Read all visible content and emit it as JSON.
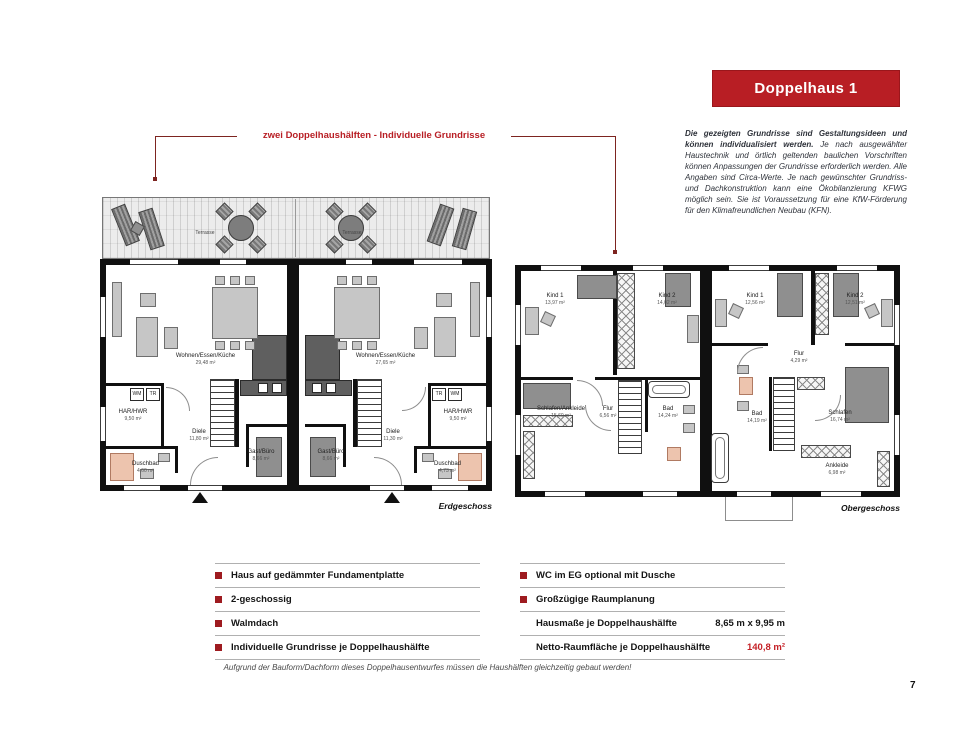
{
  "colors": {
    "accent": "#b81e24",
    "bullet": "#9e1b20",
    "value_red": "#c42026",
    "callout_line": "#7d2420"
  },
  "banner": {
    "title": "Doppelhaus 1"
  },
  "intro": {
    "bold": "Die gezeigten Grundrisse sind Gestaltungsideen und können individualisiert werden.",
    "rest": " Je nach ausgewählter Haustechnik und örtlich geltenden baulichen Vorschriften können Anpassungen der Grundrisse erforderlich werden. Alle Angaben sind Circa-Werte. Je nach gewünschter Grundriss- und Dachkonstruktion kann eine Ökobilanzierung KFWG möglich sein. Sie ist Voraussetzung für eine KfW-Förderung für den Klimafreundlichen Neubau (KFN)."
  },
  "callout": {
    "label": "zwei Doppelhaushälften - Individuelle Grundrisse"
  },
  "plans": {
    "eg": {
      "caption": "Erdgeschoss",
      "terrace_left": "Terrasse",
      "terrace_right": "Terrasse",
      "left": {
        "wohnen": {
          "name": "Wohnen/Essen/Küche",
          "area": "29,48 m²"
        },
        "har": {
          "name": "HAR/HWR",
          "area": "9,50 m²"
        },
        "diele": {
          "name": "Diele",
          "area": "11,80 m²"
        },
        "gast": {
          "name": "Gast/Büro",
          "area": "8,66 m²"
        },
        "bad": {
          "name": "Duschbad",
          "area": "4,60 m²"
        },
        "wm": "WM",
        "tr": "TR"
      },
      "right": {
        "wohnen": {
          "name": "Wohnen/Essen/Küche",
          "area": "27,65 m²"
        },
        "har": {
          "name": "HAR/HWR",
          "area": "9,50 m²"
        },
        "diele": {
          "name": "Diele",
          "area": "11,30 m²"
        },
        "gast": {
          "name": "Gast/Büro",
          "area": "8,66 m²"
        },
        "bad": {
          "name": "Duschbad",
          "area": "4,73 m²"
        },
        "tr": "TR",
        "wm": "WM"
      }
    },
    "og": {
      "caption": "Obergeschoss",
      "left": {
        "kind1": {
          "name": "Kind 1",
          "area": "13,97 m²"
        },
        "kind2": {
          "name": "Kind 2",
          "area": "14,02 m²"
        },
        "schlafen": {
          "name": "Schlafen/Ankleide",
          "area": "15,60 m²"
        },
        "flur": {
          "name": "Flur",
          "area": "6,56 m²"
        },
        "bad": {
          "name": "Bad",
          "area": "14,24 m²"
        }
      },
      "right": {
        "kind1": {
          "name": "Kind 1",
          "area": "12,56 m²"
        },
        "kind2": {
          "name": "Kind 2",
          "area": "12,51 m²"
        },
        "flur": {
          "name": "Flur",
          "area": "4,29 m²"
        },
        "bad": {
          "name": "Bad",
          "area": "14,19 m²"
        },
        "schlafen": {
          "name": "Schlafen",
          "area": "16,74 m²"
        },
        "ankleide": {
          "name": "Ankleide",
          "area": "6,98 m²"
        }
      }
    }
  },
  "features": {
    "left": [
      "Haus auf gedämmter Fundamentplatte",
      "2-geschossig",
      "Walmdach",
      "Individuelle Grundrisse je Doppelhaushälfte"
    ],
    "right_bullets": [
      "WC im EG optional mit Dusche",
      "Großzügige Raumplanung"
    ],
    "specs": [
      {
        "label": "Hausmaße je Doppelhaushälfte",
        "value": "8,65 m x 9,95 m"
      },
      {
        "label": "Netto-Raumfläche je Doppelhaushälfte",
        "value": "140,8 m²"
      }
    ]
  },
  "footnote": "Aufgrund der Bauform/Dachform dieses Doppelhausentwurfes müssen die Haushälften gleichzeitig gebaut werden!",
  "page": {
    "number": "7"
  }
}
